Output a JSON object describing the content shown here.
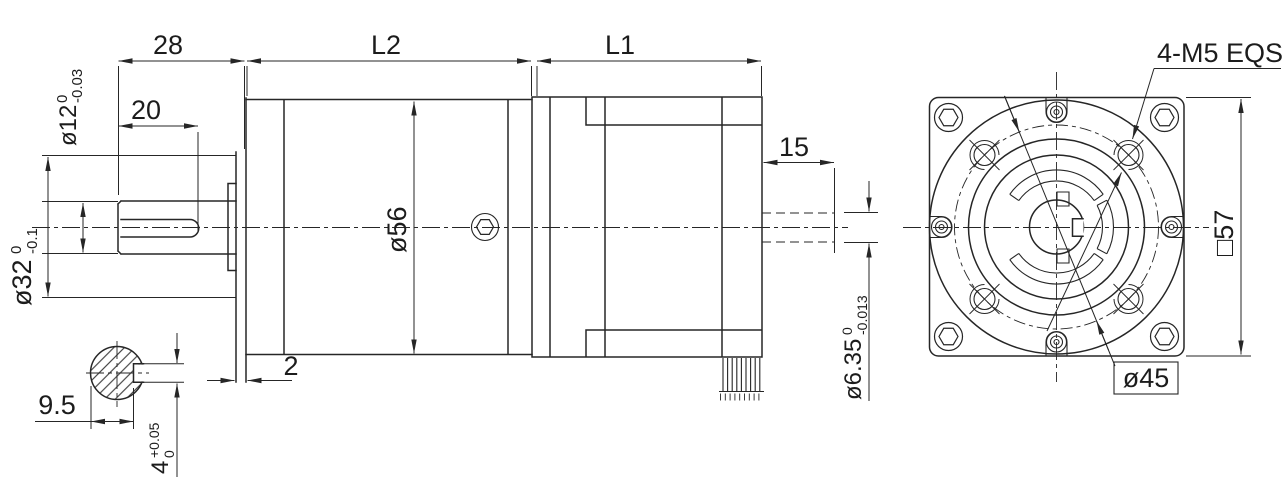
{
  "drawing_title": "gearmotor-dimension-drawing",
  "side_view": {
    "dims": {
      "shaft_extension": "28",
      "keyway_length": "20",
      "gearbox_length": "L2",
      "motor_length": "L1",
      "gearbox_diameter": "ø56",
      "flange_thickness": "2",
      "rear_shaft_length": "15",
      "shaft_diameter": {
        "nominal": "ø12",
        "tol_upper": "0",
        "tol_lower": "-0.03"
      },
      "pilot_diameter": {
        "nominal": "ø32",
        "tol_upper": "0",
        "tol_lower": "-0.1"
      },
      "rear_shaft_diameter": {
        "nominal": "ø6.35",
        "tol_upper": "0",
        "tol_lower": "-0.013"
      }
    },
    "section": {
      "flat_to_slot_bottom": "9.5",
      "key_width": {
        "nominal": "4",
        "tol_upper": "+0.05",
        "tol_lower": "0"
      }
    }
  },
  "front_view": {
    "labels": {
      "tapped_holes": "4-M5 EQS",
      "bolt_circle_diameter": "ø45",
      "flange_size": "□57"
    }
  }
}
